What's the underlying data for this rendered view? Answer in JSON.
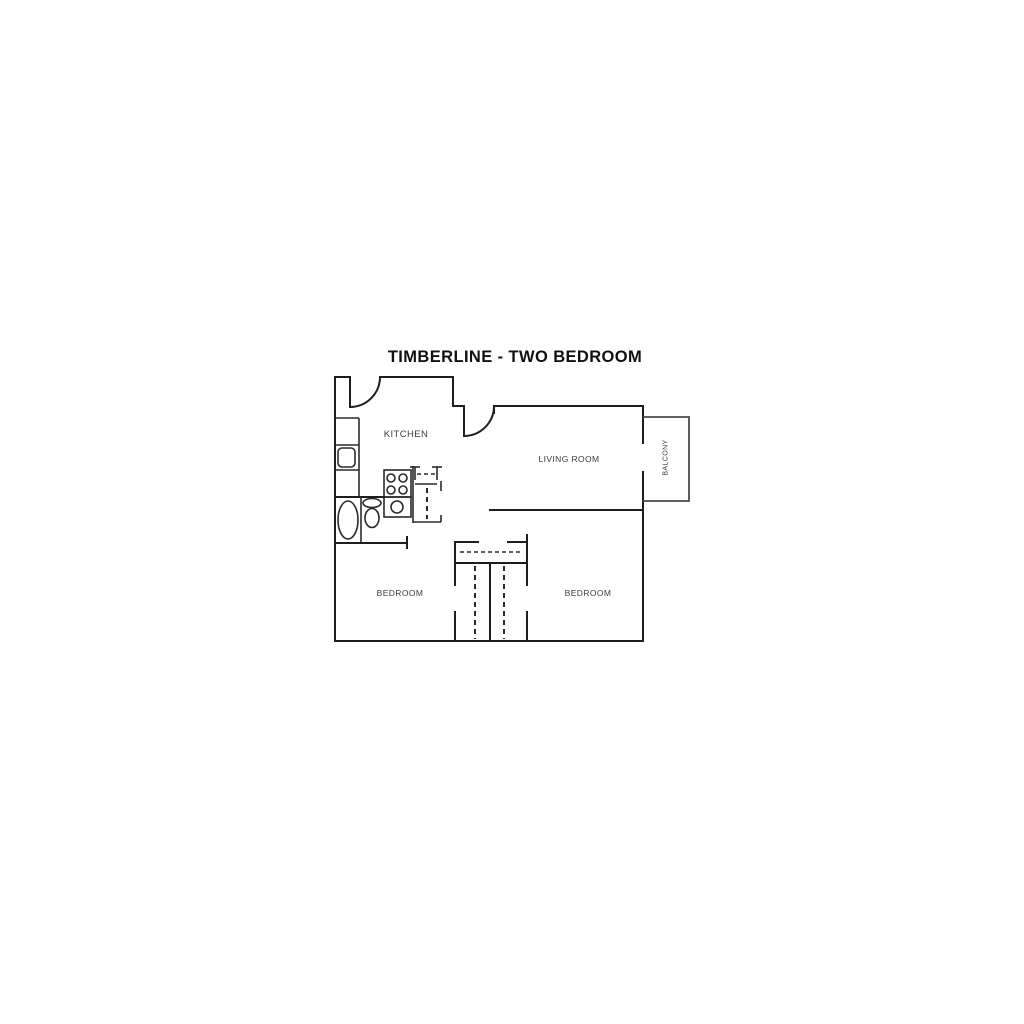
{
  "title": "TIMBERLINE - TWO BEDROOM",
  "rooms": {
    "kitchen": "KITCHEN",
    "living_room": "LIVING ROOM",
    "balcony": "BALCONY",
    "bedroom_left": "BEDROOM",
    "bedroom_right": "BEDROOM"
  },
  "colors": {
    "wall": "#1e1e1e",
    "balcony_outline": "#4a4a4a",
    "fixture": "#2a2a2a",
    "label": "#3c3c3c",
    "title": "#111111",
    "background": "#ffffff"
  }
}
